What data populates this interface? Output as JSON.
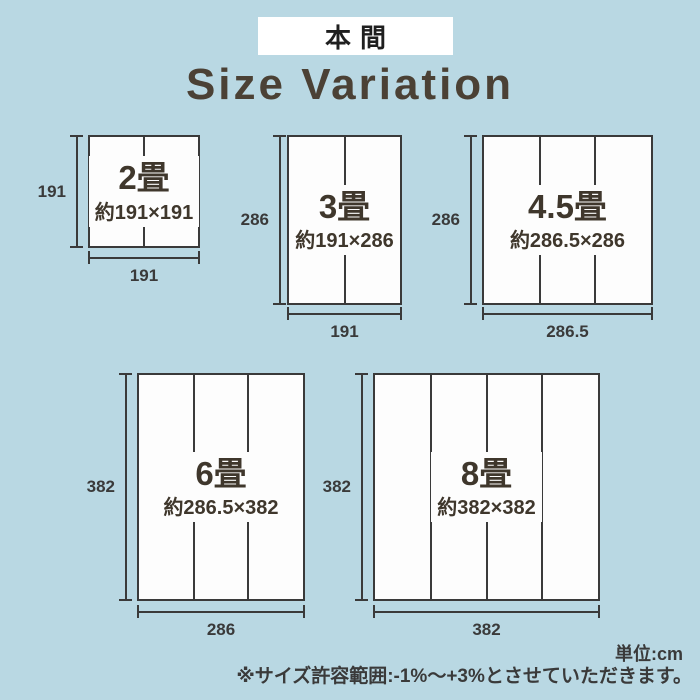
{
  "header": {
    "brand_label": "本間",
    "title": "Size Variation"
  },
  "sizes": [
    {
      "name": "2畳",
      "dims": "約191×191",
      "height_label": "191",
      "width_label": "191",
      "panels": 2
    },
    {
      "name": "3畳",
      "dims": "約191×286",
      "height_label": "286",
      "width_label": "191",
      "panels": 2
    },
    {
      "name": "4.5畳",
      "dims": "約286.5×286",
      "height_label": "286",
      "width_label": "286.5",
      "panels": 3
    },
    {
      "name": "6畳",
      "dims": "約286.5×382",
      "height_label": "382",
      "width_label": "286",
      "panels": 3
    },
    {
      "name": "8畳",
      "dims": "約382×382",
      "height_label": "382",
      "width_label": "382",
      "panels": 4
    }
  ],
  "footer": {
    "unit_label": "単位:cm",
    "note": "※サイズ許容範囲:-1%〜+3%とさせていただきます。"
  },
  "colors": {
    "background": "#b9d8e3",
    "line": "#3a3a3a",
    "ink": "#3f372c",
    "num": "#3a3a3a",
    "title": "#4b4135",
    "rect-fill": "#fdfdfd",
    "brand-ink": "#1f1f1f"
  }
}
